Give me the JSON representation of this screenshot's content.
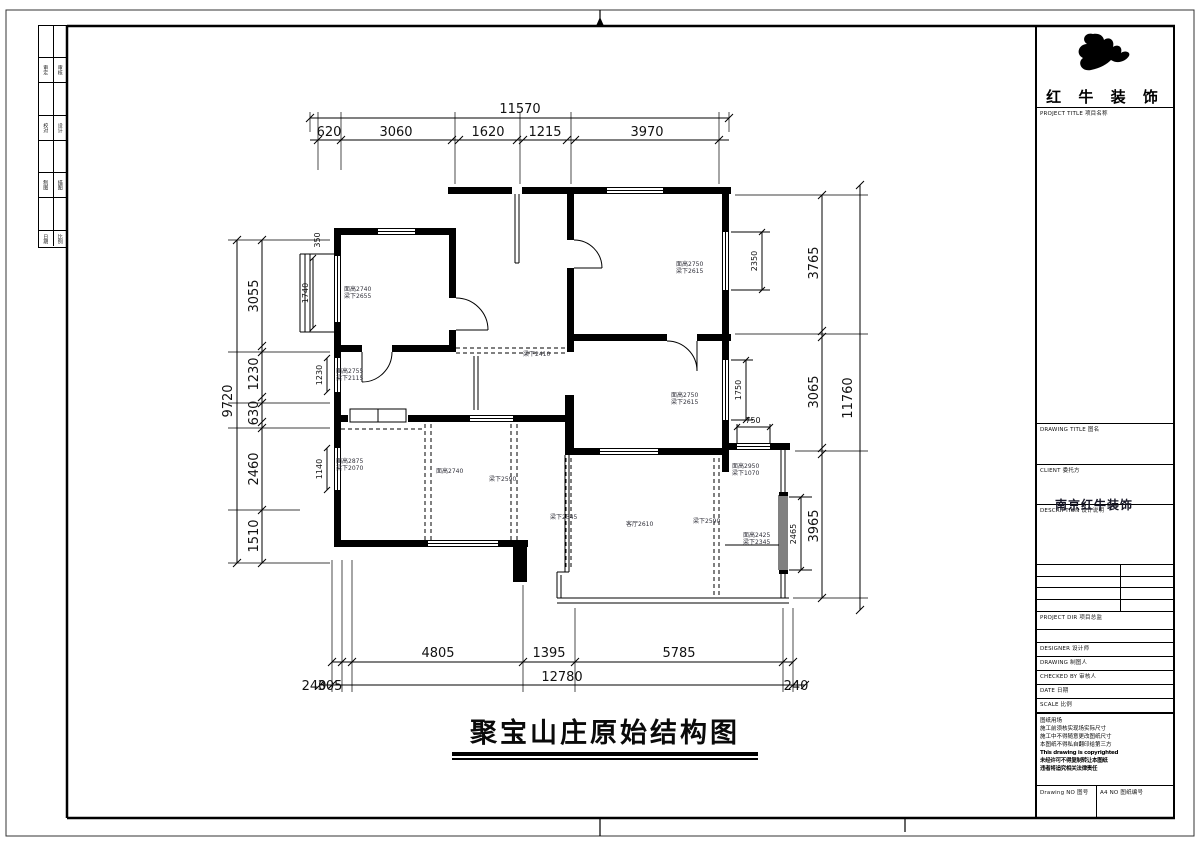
{
  "title": {
    "text": "聚宝山庄原始结构图"
  },
  "company": {
    "name": "红 牛 装 饰",
    "project_title_label": "PROJECT TITLE 项目名称"
  },
  "titleblock": {
    "drawing_title_label": "DRAWING TITLE 图名",
    "client_label": "CLIENT 委托方",
    "stamp": "南京红牛装饰",
    "description_label": "DESCRIPTION 设计说明",
    "project_dir_label": "PROJECT DIR 项目总监",
    "designer_label": "DESIGNER 设计师",
    "drawing_label": "DRAWING 制图人",
    "checked_label": "CHECKED BY 审核人",
    "date_label": "DATE 日期",
    "scale_label": "SCALE 比例",
    "notes": [
      "图纸用场",
      "施工前须核实现场实际尺寸",
      "施工中不得随意更改图纸尺寸",
      "本图纸不得私自翻印给第三方",
      "This drawing is copyrighted",
      "未经许可不得复制转让本图纸",
      "违者将追究相关法律责任"
    ],
    "drawing_no_label": "Drawing NO 图号",
    "a4_no_label": "A4 NO 图纸编号"
  },
  "left_strip": {
    "rows": [
      {
        "a": "审定",
        "b": "审核"
      },
      {
        "a": "校对",
        "b": "设计"
      },
      {
        "a": "制图",
        "b": "描图"
      },
      {
        "a": "日期",
        "b": "比例"
      }
    ]
  },
  "dims": {
    "top": {
      "total": "11570",
      "segments": [
        "620",
        "3060",
        "1620",
        "1215",
        "3970"
      ]
    },
    "left": {
      "total": "9720",
      "segments": [
        "3055",
        "1230",
        "630",
        "2460",
        "1510"
      ]
    },
    "right": {
      "total": "11760",
      "segments": [
        "3765",
        "3065",
        "3965"
      ]
    },
    "bottom": {
      "segments": [
        "4805",
        "1395",
        "5785"
      ],
      "total": "12780",
      "edge_left_a": "240",
      "edge_left_b": "305",
      "edge_right": "240"
    },
    "windows": {
      "w350": "350",
      "w1740": "1740",
      "w1230": "1230",
      "w1140": "1140",
      "w2350": "2350",
      "w1750": "1750",
      "w750": "750",
      "w2465": "2465"
    }
  },
  "annotations": [
    {
      "l1": "面高2740",
      "l2": "梁下2655"
    },
    {
      "l1": "面高2750",
      "l2": "梁下2615"
    },
    {
      "l1": "面高2755",
      "l2": "梁下2115"
    },
    {
      "l1": "面高2750",
      "l2": "梁下2615"
    },
    {
      "l1": "梁下2410"
    },
    {
      "l1": "面高2875",
      "l2": "梁下2070"
    },
    {
      "l1": "面高2740"
    },
    {
      "l1": "梁下2590"
    },
    {
      "l1": "梁下2345"
    },
    {
      "l1": "客厅2610"
    },
    {
      "l1": "梁下2590"
    },
    {
      "l1": "面高2950",
      "l2": "梁下1070"
    },
    {
      "l1": "面高2425",
      "l2": "梁下2345"
    }
  ]
}
